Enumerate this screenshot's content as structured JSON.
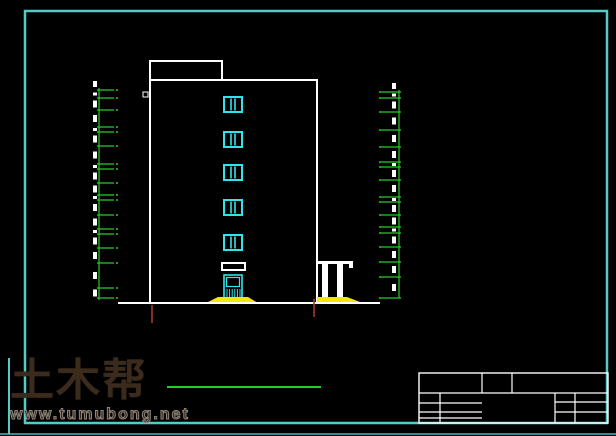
{
  "watermark": {
    "logo": "土木帮",
    "url": "www.tumubong.net"
  },
  "colors": {
    "background": "#000000",
    "frame_teal": "#55cbc6",
    "frame_teal_dim": "#2f8f8b",
    "drawing_white": "#ffffff",
    "window_cyan": "#31e3ea",
    "dimension_green": "#25cc25",
    "steps_yellow": "#f2e800",
    "marker_red": "#a53a2a",
    "watermark_brown": "#3b2b1c"
  },
  "drawing": {
    "frame": {
      "x": 25,
      "y": 11,
      "w": 582,
      "h": 412
    },
    "frame_bottom_edge": {
      "y": 434
    },
    "watermark_accent": {
      "x": 9,
      "y1": 358,
      "y2": 434
    },
    "building": {
      "x": 150,
      "y": 80,
      "w": 167,
      "h": 223
    },
    "bulkhead": {
      "x": 150,
      "y": 61,
      "w": 72,
      "h": 19
    },
    "marker_square": {
      "x": 143,
      "y": 92,
      "w": 5,
      "h": 5
    },
    "windows": {
      "x": 224,
      "w": 18,
      "h": 15,
      "tops": [
        97,
        132,
        165,
        200,
        235
      ]
    },
    "door": {
      "x": 224,
      "y": 275,
      "w": 18,
      "h": 23
    },
    "canopy": {
      "x": 222,
      "y": 263,
      "w": 23,
      "h": 7
    },
    "porch": {
      "beam": {
        "x": 318,
        "y": 261,
        "w": 35,
        "h": 3
      },
      "beam_cap": {
        "x": 349,
        "y": 264,
        "w": 4,
        "h": 4
      },
      "columns_x": [
        322,
        337
      ],
      "col_w": 6,
      "col_y": 264,
      "col_h": 34
    },
    "ground": {
      "x1": 118,
      "x2": 380,
      "y": 303
    },
    "steps_left": [
      [
        206,
        303
      ],
      [
        218,
        297
      ],
      [
        248,
        297
      ],
      [
        258,
        303
      ]
    ],
    "steps_right": [
      [
        317,
        303
      ],
      [
        317,
        297
      ],
      [
        347,
        297
      ],
      [
        360,
        302
      ],
      [
        360,
        303
      ]
    ],
    "red_marks": [
      {
        "x": 152,
        "y1": 305,
        "y2": 323
      },
      {
        "x": 314,
        "y1": 299,
        "y2": 317
      }
    ],
    "dim_left": {
      "line_x": 99,
      "y1": 88,
      "y2": 300,
      "tick_x2": 114,
      "dot_x": 117,
      "text_x": 93,
      "ticks": [
        90,
        98,
        110,
        127,
        132,
        146,
        164,
        169,
        183,
        195,
        200,
        215,
        229,
        234,
        248,
        263,
        288,
        298
      ]
    },
    "dim_right": {
      "line_x": 399,
      "y1": 90,
      "y2": 298,
      "tick_x1": 381,
      "dot_x": 380,
      "text_x": 392,
      "ticks": [
        92,
        98,
        112,
        130,
        147,
        162,
        167,
        180,
        197,
        202,
        215,
        227,
        233,
        247,
        262,
        277,
        298
      ]
    },
    "green_line": {
      "x1": 167,
      "x2": 321,
      "y": 387
    },
    "title_block": {
      "outline": {
        "x": 419,
        "y": 373,
        "w": 189,
        "h": 50
      },
      "lines": [
        [
          419,
          393,
          608,
          393
        ],
        [
          482,
          373,
          482,
          393
        ],
        [
          512,
          373,
          512,
          393
        ],
        [
          440,
          393,
          440,
          423
        ],
        [
          419,
          403,
          482,
          403
        ],
        [
          419,
          412,
          482,
          412
        ],
        [
          419,
          418,
          482,
          418
        ],
        [
          555,
          393,
          555,
          423
        ],
        [
          575,
          393,
          575,
          423
        ],
        [
          555,
          402,
          608,
          402
        ],
        [
          555,
          412,
          608,
          412
        ]
      ]
    }
  }
}
